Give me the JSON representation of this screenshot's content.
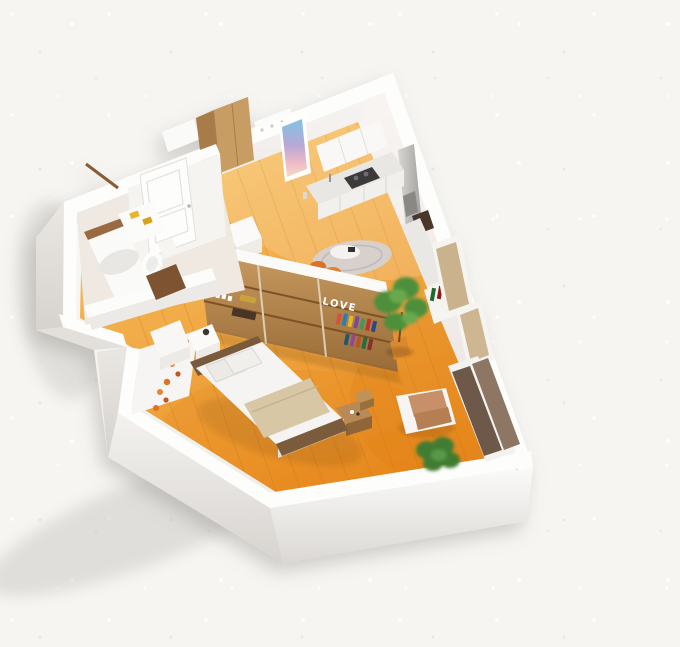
{
  "scene": {
    "love_text": "LOVE"
  },
  "palette": {
    "background": "#f6f5f2",
    "wall_top": "#fcfcfb",
    "wall_face": "#f5f3f1",
    "wall_shade": "#dcd9d5",
    "floor_light": "#f8c466",
    "floor_deep": "#e8891d",
    "divider_wood": "#bb8d52",
    "wood_dark": "#7a5a3c",
    "accent_orange": "#dd7226",
    "plant_green": "#4e8f3a",
    "blanket_beige": "#d8c7a4",
    "towel_yellow": "#e7b42c",
    "cushion_tan": "#c89067",
    "closet_dark": "#6e5948",
    "closet_mid": "#8d7663"
  }
}
